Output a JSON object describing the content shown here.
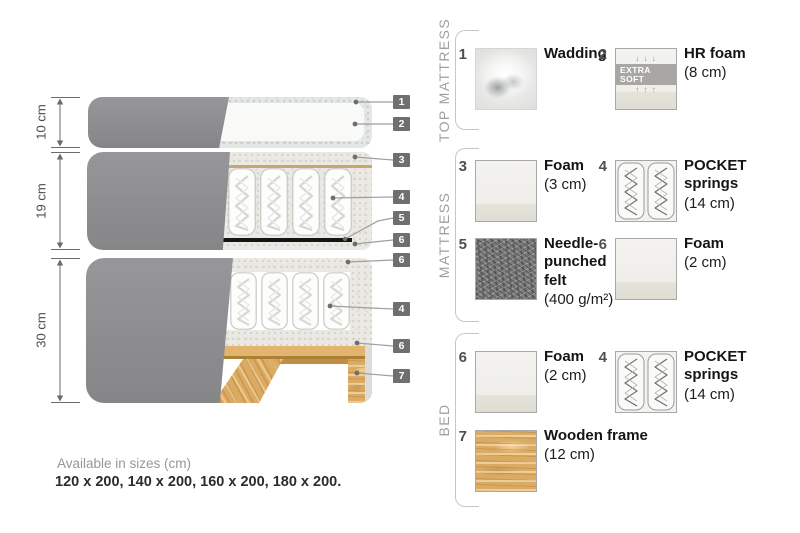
{
  "diagram": {
    "dim_top": "10 cm",
    "dim_mid": "19 cm",
    "dim_bed": "30 cm",
    "callouts": {
      "c1": "1",
      "c2": "2",
      "c3": "3",
      "c4": "4",
      "c5": "5",
      "c6a": "6",
      "c6b": "6",
      "c4b": "4",
      "c6c": "6",
      "c7": "7"
    }
  },
  "legend": {
    "section_top": "TOP MATTRESS",
    "section_mid": "MATTRESS",
    "section_bed": "BED",
    "items": {
      "wadding": {
        "num": "1",
        "line1": "Wadding",
        "detail": ""
      },
      "hr_foam": {
        "num": "2",
        "line1": "HR foam",
        "detail": "(8 cm)",
        "badge": "EXTRA SOFT",
        "arrows_down": "↓ ↓ ↓",
        "arrows_up": "↑ ↑ ↑"
      },
      "foam_3": {
        "num": "3",
        "line1": "Foam",
        "detail": "(3 cm)"
      },
      "springs_m": {
        "num": "4",
        "line1": "POCKET",
        "line2": "springs",
        "detail": "(14 cm)"
      },
      "felt": {
        "num": "5",
        "line1": "Needle-",
        "line2": "punched",
        "line3": "felt",
        "detail": "(400 g/m²)"
      },
      "foam_m": {
        "num": "6",
        "line1": "Foam",
        "detail": "(2 cm)"
      },
      "foam_b": {
        "num": "6",
        "line1": "Foam",
        "detail": "(2 cm)"
      },
      "springs_b": {
        "num": "4",
        "line1": "POCKET",
        "line2": "springs",
        "detail": "(14 cm)"
      },
      "wood": {
        "num": "7",
        "line1": "Wooden frame",
        "detail": "(12 cm)"
      }
    }
  },
  "footer": {
    "title": "Available in sizes (cm)",
    "sizes": "120 x 200, 140 x 200, 160 x 200, 180 x 200."
  },
  "colors": {
    "fabric": "#8f8f90",
    "wood": "#dcab63",
    "felt": "#7d7d7d",
    "callout_bg": "#6f6f6f",
    "accent_tan": "#c9a571"
  }
}
